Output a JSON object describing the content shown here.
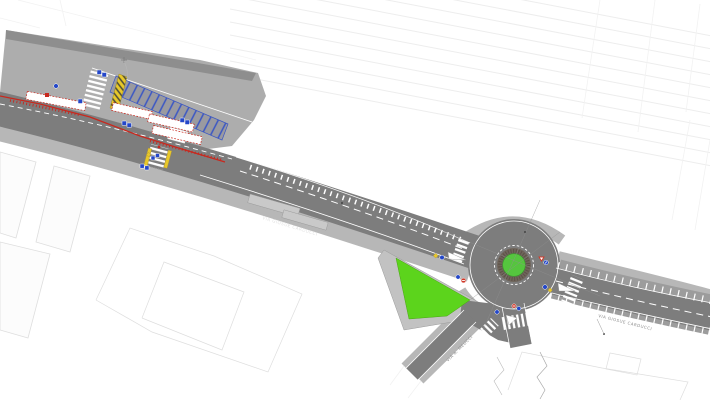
{
  "drawing": {
    "type": "road-design-plan",
    "labels": {
      "main_road_1": "VIA GIOSUE CARDUCCI",
      "main_road_2": "VIA GIOSUE CARDUCCI",
      "side_street": "VIA A. MEUCCI"
    },
    "colors": {
      "background": "#ffffff",
      "asphalt": "#7d7d7d",
      "plaza": "#adadad",
      "plaza_wall": "#8e8e8e",
      "sidewalk": "#b7b7b7",
      "parking_band": "#9c9c9c",
      "grass_island": "#5cd41c",
      "roundabout_apron": "#6f655b",
      "roundabout_green": "#55c53e",
      "parking_bay_blue": "#3a56c4",
      "route_red": "#c8281e",
      "hazard_yellow": "#e8c82a",
      "sign_blue": "#2447c8",
      "sign_red": "#d03a2a",
      "marking_white": "#ffffff",
      "survey_line": "#ededed",
      "building_line": "#dedede"
    },
    "icons": {
      "blue-rect-sign": "small blue rectangular traffic sign plate",
      "blue-circle-sign": "blue circular mandatory direction sign",
      "yield-sign": "red and white give-way triangle",
      "no-entry-sign": "red circular no-entry sign",
      "hazard-diamond-sign": "yellow warning diamond",
      "survey-cross": "surveyor benchmark cross"
    }
  }
}
